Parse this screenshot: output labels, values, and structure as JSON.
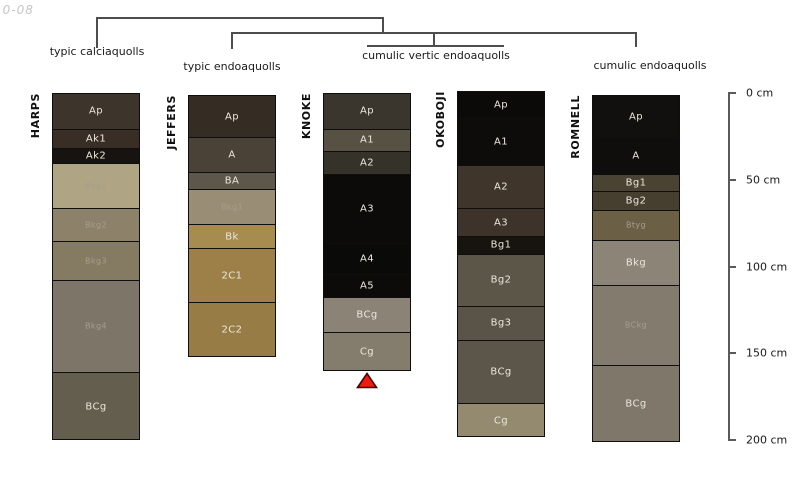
{
  "corner_text": "10-08",
  "chart_data": {
    "type": "bar",
    "variant": "stacked-soil-horizon-profiles-with-dendrogram",
    "title": "",
    "depth_axis": {
      "unit": "cm",
      "range": [
        0,
        200
      ],
      "ticks": [
        "0 cm",
        "50 cm",
        "100 cm",
        "150 cm",
        "200 cm"
      ],
      "position": "right"
    },
    "dendrogram_labels": [
      "typic calciaquolls",
      "typic endoaquolls",
      "cumulic vertic endoaquolls",
      "cumulic endoaquolls"
    ],
    "categories": [
      "HARPS",
      "JEFFERS",
      "KNOKE",
      "OKOBOJI",
      "ROMNELL"
    ],
    "columns": [
      {
        "name": "HARPS",
        "group": "typic calciaquolls",
        "horizons": [
          {
            "label": "Ap",
            "color": "#3d342c",
            "top_cm": 0,
            "bottom_cm": 20,
            "small": false
          },
          {
            "label": "Ak1",
            "color": "#392e25",
            "top_cm": 20,
            "bottom_cm": 31,
            "small": false
          },
          {
            "label": "Ak2",
            "color": "#161310",
            "top_cm": 31,
            "bottom_cm": 40,
            "small": false
          },
          {
            "label": "Bkg1",
            "color": "#afa584",
            "top_cm": 40,
            "bottom_cm": 66,
            "small": true
          },
          {
            "label": "Bkg2",
            "color": "#8d8269",
            "top_cm": 66,
            "bottom_cm": 85,
            "small": true
          },
          {
            "label": "Bkg3",
            "color": "#857b63",
            "top_cm": 85,
            "bottom_cm": 107,
            "small": true
          },
          {
            "label": "Bkg4",
            "color": "#7d7668",
            "top_cm": 107,
            "bottom_cm": 160,
            "small": true
          },
          {
            "label": "BCg",
            "color": "#645e4e",
            "top_cm": 160,
            "bottom_cm": 200,
            "small": false
          }
        ]
      },
      {
        "name": "JEFFERS",
        "group": "typic endoaquolls",
        "horizons": [
          {
            "label": "Ap",
            "color": "#352d23",
            "top_cm": 1,
            "bottom_cm": 25,
            "small": false
          },
          {
            "label": "A",
            "color": "#4a4236",
            "top_cm": 25,
            "bottom_cm": 45,
            "small": false
          },
          {
            "label": "BA",
            "color": "#5d564b",
            "top_cm": 45,
            "bottom_cm": 55,
            "small": false
          },
          {
            "label": "Bkg1",
            "color": "#998d76",
            "top_cm": 55,
            "bottom_cm": 75,
            "small": true
          },
          {
            "label": "Bk",
            "color": "#a78c50",
            "top_cm": 75,
            "bottom_cm": 89,
            "small": false
          },
          {
            "label": "2C1",
            "color": "#9c8048",
            "top_cm": 89,
            "bottom_cm": 120,
            "small": false
          },
          {
            "label": "2C2",
            "color": "#987c45",
            "top_cm": 120,
            "bottom_cm": 152,
            "small": false
          }
        ]
      },
      {
        "name": "KNOKE",
        "group": "cumulic vertic endoaquolls",
        "horizons": [
          {
            "label": "Ap",
            "color": "#3a362e",
            "top_cm": 0,
            "bottom_cm": 20,
            "small": false
          },
          {
            "label": "A1",
            "color": "#575143",
            "top_cm": 20,
            "bottom_cm": 33,
            "small": false
          },
          {
            "label": "A2",
            "color": "#35322a",
            "top_cm": 33,
            "bottom_cm": 46,
            "small": false
          },
          {
            "label": "A3",
            "color": "#0c0b0a",
            "top_cm": 46,
            "bottom_cm": 86,
            "small": false
          },
          {
            "label": "A4",
            "color": "#0a0a09",
            "top_cm": 86,
            "bottom_cm": 104,
            "small": false
          },
          {
            "label": "A5",
            "color": "#0c0b0a",
            "top_cm": 104,
            "bottom_cm": 117,
            "small": false
          },
          {
            "label": "BCg",
            "color": "#8b8375",
            "top_cm": 117,
            "bottom_cm": 137,
            "small": false
          },
          {
            "label": "Cg",
            "color": "#847d6e",
            "top_cm": 137,
            "bottom_cm": 160,
            "small": false
          }
        ]
      },
      {
        "name": "OKOBOJI",
        "group": "cumulic vertic endoaquolls",
        "horizons": [
          {
            "label": "Ap",
            "color": "#0b0a09",
            "top_cm": -1,
            "bottom_cm": 14,
            "small": false
          },
          {
            "label": "A1",
            "color": "#0d0c0b",
            "top_cm": 14,
            "bottom_cm": 41,
            "small": false
          },
          {
            "label": "A2",
            "color": "#40352b",
            "top_cm": 41,
            "bottom_cm": 66,
            "small": false
          },
          {
            "label": "A3",
            "color": "#3d332a",
            "top_cm": 66,
            "bottom_cm": 82,
            "small": false
          },
          {
            "label": "Bg1",
            "color": "#17140f",
            "top_cm": 82,
            "bottom_cm": 92,
            "small": false
          },
          {
            "label": "Bg2",
            "color": "#5c5648",
            "top_cm": 92,
            "bottom_cm": 122,
            "small": false
          },
          {
            "label": "Bg3",
            "color": "#5a5448",
            "top_cm": 122,
            "bottom_cm": 142,
            "small": false
          },
          {
            "label": "BCg",
            "color": "#5b5649",
            "top_cm": 142,
            "bottom_cm": 178,
            "small": false
          },
          {
            "label": "Cg",
            "color": "#938a70",
            "top_cm": 178,
            "bottom_cm": 198,
            "small": false
          }
        ]
      },
      {
        "name": "ROMNELL",
        "group": "cumulic endoaquolls",
        "horizons": [
          {
            "label": "Ap",
            "color": "#11100e",
            "top_cm": 1,
            "bottom_cm": 25,
            "small": false
          },
          {
            "label": "A",
            "color": "#0f0e0c",
            "top_cm": 25,
            "bottom_cm": 46,
            "small": false
          },
          {
            "label": "Bg1",
            "color": "#4a4232",
            "top_cm": 46,
            "bottom_cm": 56,
            "small": false
          },
          {
            "label": "Bg2",
            "color": "#463f30",
            "top_cm": 56,
            "bottom_cm": 67,
            "small": false
          },
          {
            "label": "Btyg",
            "color": "#6b5f45",
            "top_cm": 67,
            "bottom_cm": 84,
            "small": true
          },
          {
            "label": "Bkg",
            "color": "#8c8476",
            "top_cm": 84,
            "bottom_cm": 110,
            "small": false
          },
          {
            "label": "BCkg",
            "color": "#837c6e",
            "top_cm": 110,
            "bottom_cm": 156,
            "small": true
          },
          {
            "label": "BCg",
            "color": "#7f786a",
            "top_cm": 156,
            "bottom_cm": 201,
            "small": false
          }
        ]
      }
    ],
    "marker": {
      "type": "triangle-up",
      "below_column": "KNOKE",
      "fill": "#ee1b0e",
      "stroke": "#450000"
    }
  }
}
